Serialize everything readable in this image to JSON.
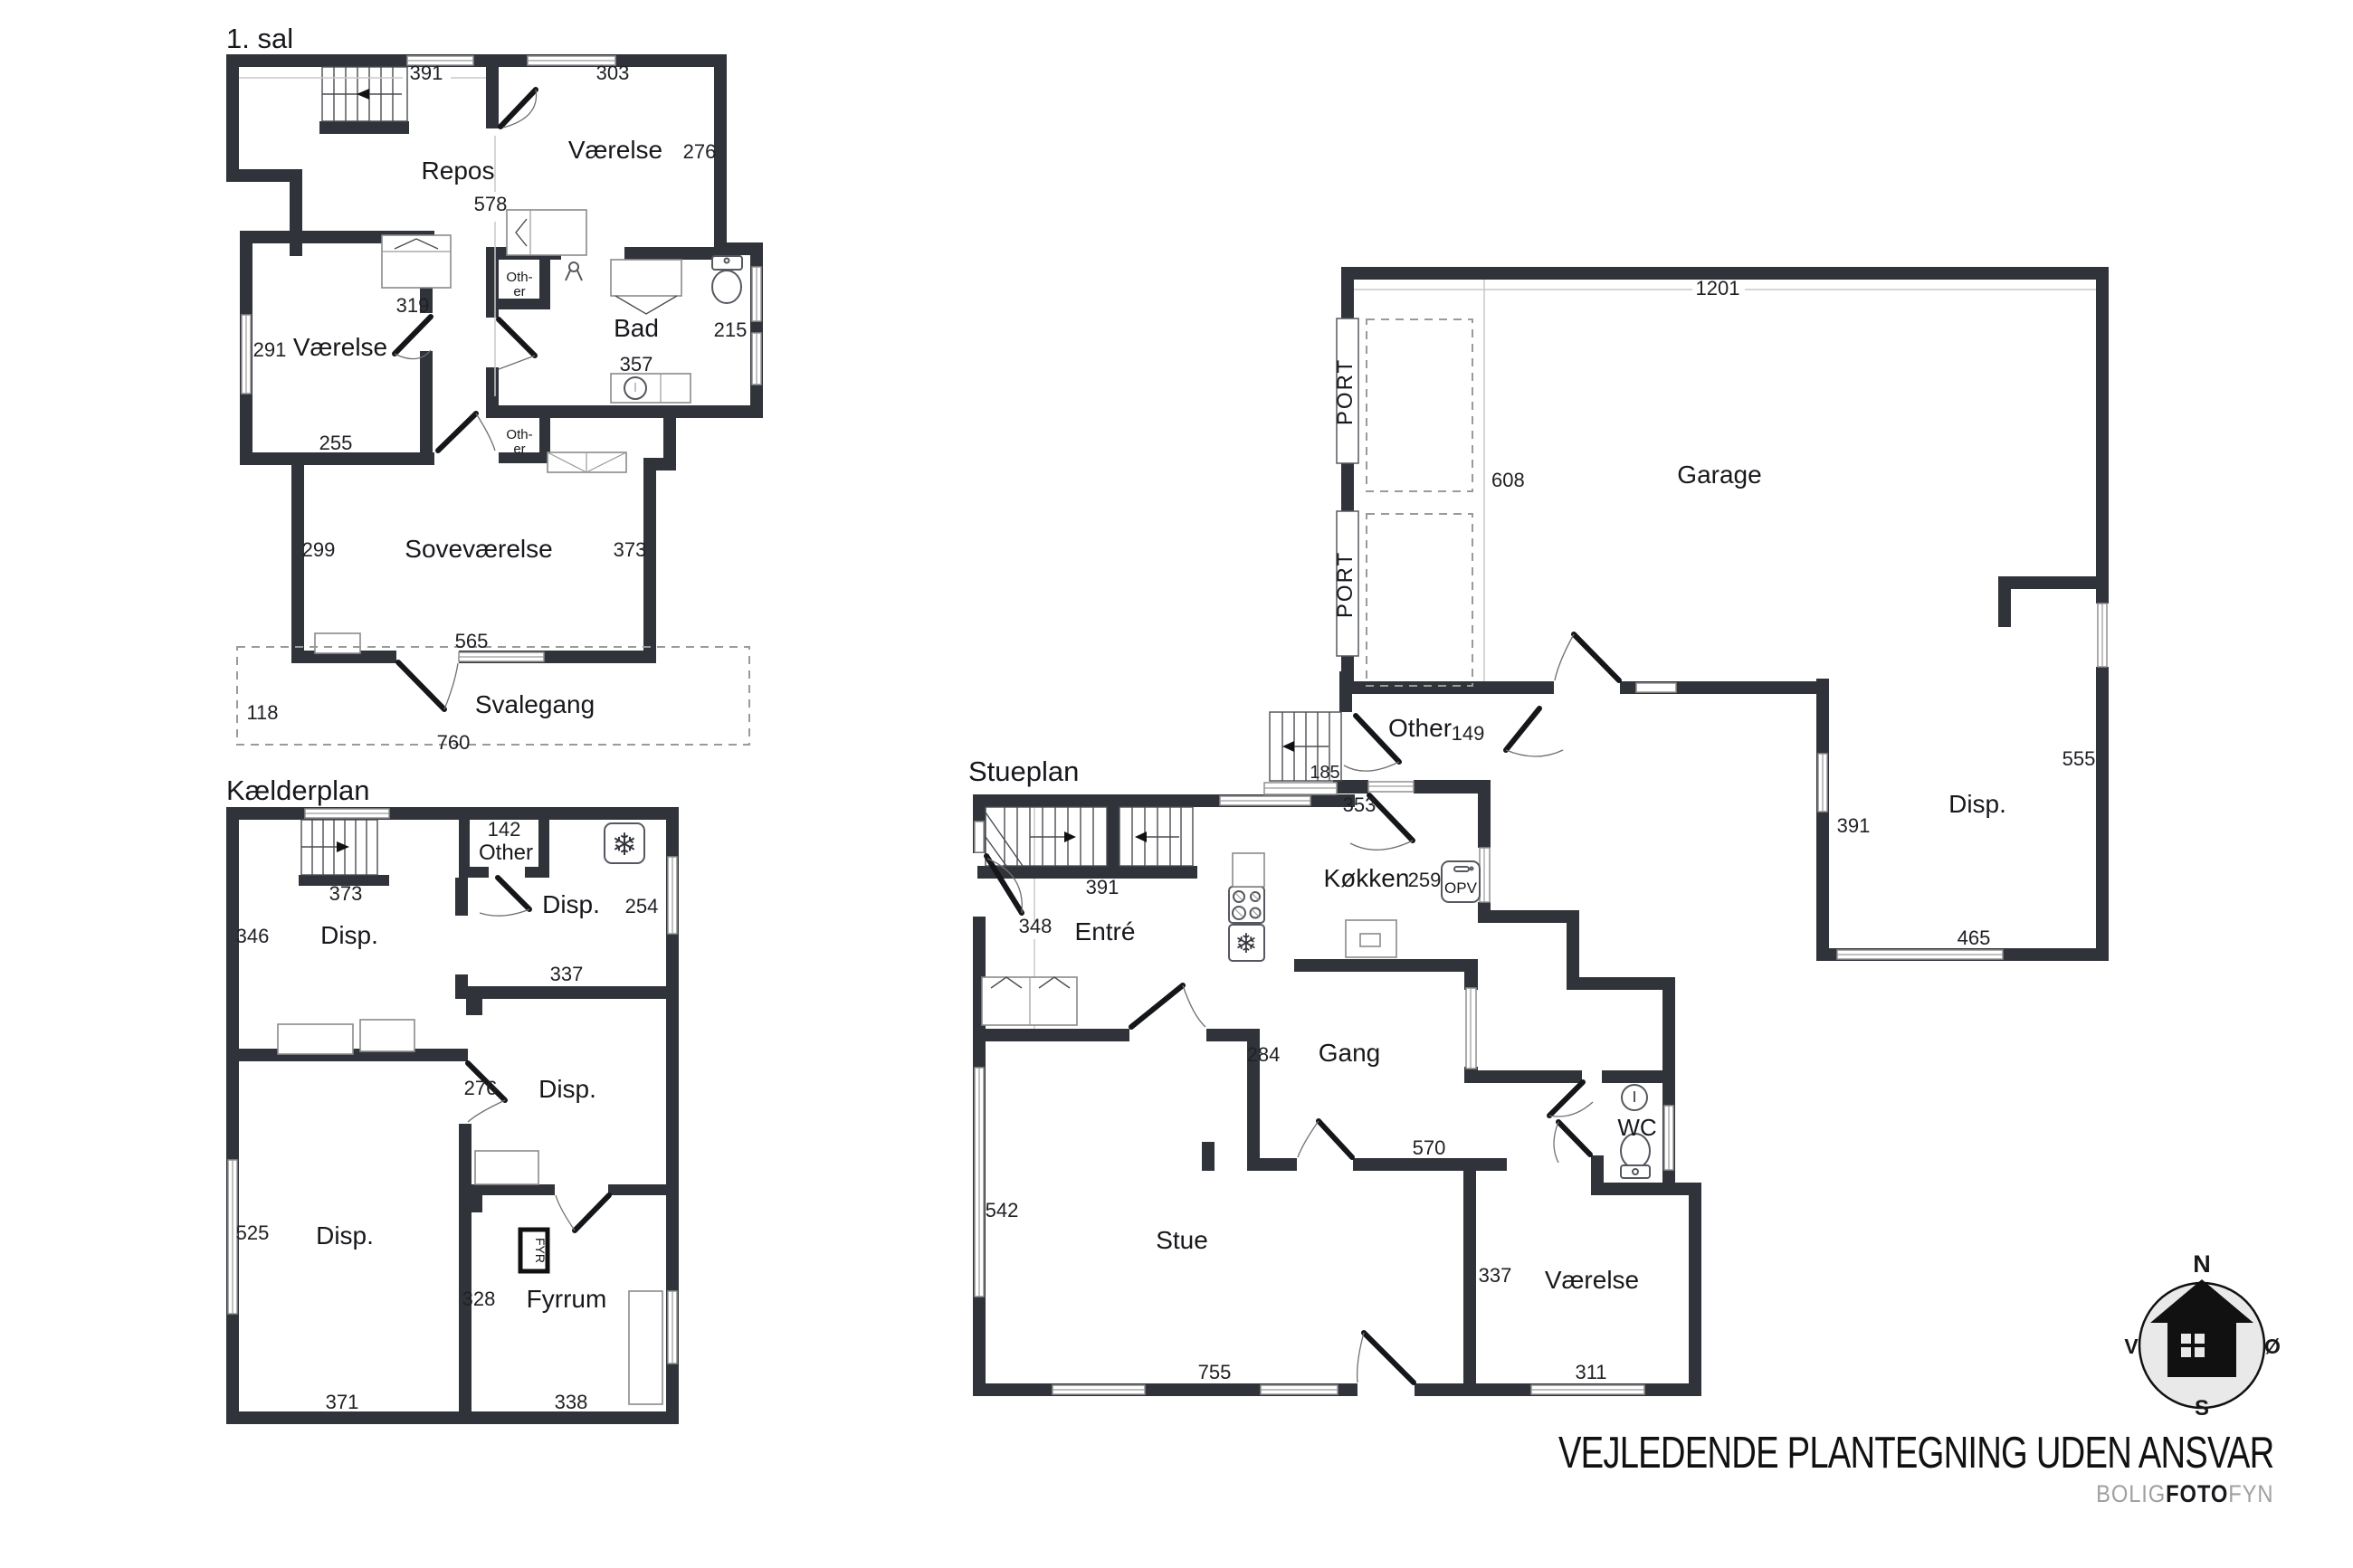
{
  "plans": {
    "first_floor": {
      "title": "1. sal",
      "rooms": {
        "repos": "Repos",
        "vaerelse_right": "Værelse",
        "bad": "Bad",
        "vaerelse_left": "Værelse",
        "sovevaerelse": "Soveværelse",
        "svalegang": "Svalegang"
      },
      "labels": {
        "other_l1": "Oth-",
        "other_l2": "er"
      },
      "dims": {
        "d391": "391",
        "d303": "303",
        "d276": "276",
        "d578": "578",
        "d319": "319",
        "d291": "291",
        "d255": "255",
        "d215": "215",
        "d357": "357",
        "d299": "299",
        "d373": "373",
        "d565": "565",
        "d118": "118",
        "d760": "760"
      }
    },
    "basement": {
      "title": "Kælderplan",
      "rooms": {
        "other": "Other",
        "disp_nw": "Disp.",
        "disp_ne": "Disp.",
        "disp_mid": "Disp.",
        "disp_sw": "Disp.",
        "fyrrum": "Fyrrum"
      },
      "labels": {
        "fyr": "FYR"
      },
      "dims": {
        "d142": "142",
        "d373": "373",
        "d346": "346",
        "d254": "254",
        "d337": "337",
        "d276": "276",
        "d525": "525",
        "d328": "328",
        "d371": "371",
        "d338": "338"
      }
    },
    "ground_floor": {
      "title": "Stueplan",
      "rooms": {
        "garage": "Garage",
        "port_top": "PORT",
        "port_bottom": "PORT",
        "other": "Other",
        "entre": "Entré",
        "koekken": "Køkken",
        "gang": "Gang",
        "wc": "WC",
        "stue": "Stue",
        "vaerelse": "Værelse",
        "disp": "Disp."
      },
      "labels": {
        "opv": "OPV"
      },
      "dims": {
        "d1201": "1201",
        "d608": "608",
        "d149": "149",
        "d185": "185",
        "d353": "353",
        "d391_stairs": "391",
        "d348": "348",
        "d259": "259",
        "d284": "284",
        "d570": "570",
        "d542": "542",
        "d755": "755",
        "d311": "311",
        "d337": "337",
        "d555": "555",
        "d391_disp": "391",
        "d465": "465"
      }
    }
  },
  "compass": {
    "n": "N",
    "s": "S",
    "v": "V",
    "oe": "Ø"
  },
  "footer": {
    "disclaimer": "VEJLEDENDE PLANTEGNING UDEN ANSVAR",
    "brand_1": "BOLIG",
    "brand_2": "FOTO",
    "brand_3": "FYN"
  }
}
